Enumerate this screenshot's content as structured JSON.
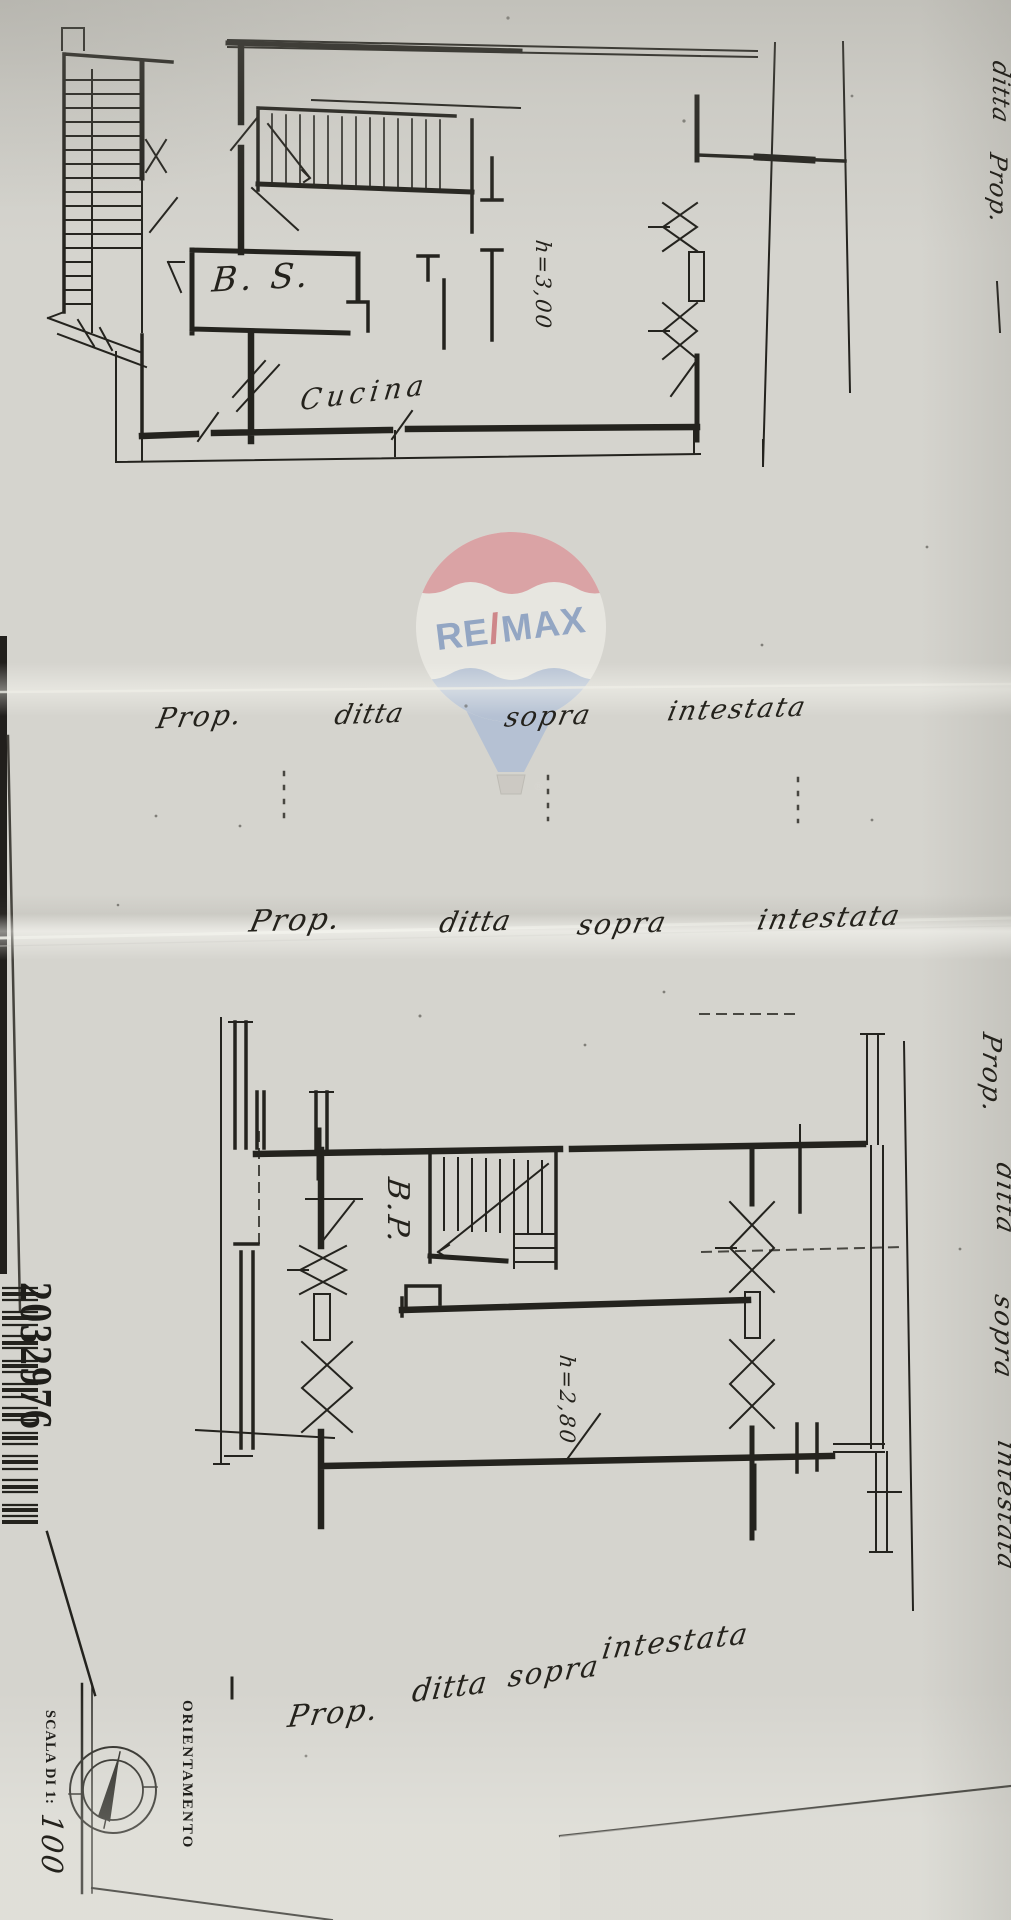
{
  "colors": {
    "paper": "#d5d4ce",
    "ink": "#22211d",
    "balloon_red": "#dc9196",
    "balloon_blue": "#a9bbd6",
    "logo_text_blue": "#7b95c0",
    "logo_slash_red": "#cc6a70",
    "basket_gray": "#c9c6bf"
  },
  "watermark": {
    "brand_left": "RE",
    "brand_slash": "/",
    "brand_right": "MAX",
    "registered": "®"
  },
  "upper_plan": {
    "room_bs": "B. S.",
    "room_kitchen": "Cucina",
    "ceiling_height": "h=3,00"
  },
  "lower_plan": {
    "room_bp": "B.P.",
    "ceiling_height": "h=2,80"
  },
  "annotations": {
    "row1": {
      "w1": "Prop.",
      "w2": "ditta",
      "w3": "sopra",
      "w4": "intestata"
    },
    "row2": {
      "w1": "Prop.",
      "w2": "ditta",
      "w3": "sopra",
      "w4": "intestata"
    },
    "row3": {
      "w1": "Prop.",
      "w2": "ditta",
      "w3": "sopra",
      "w4": "intestata"
    },
    "right_margin": {
      "w1": "Prop.",
      "w2": "ditta",
      "w3": "sopra",
      "w4": "intestata"
    },
    "top_right": {
      "f1": "ditta",
      "f2": "Prop."
    }
  },
  "stamps": {
    "registry_number": "2032976"
  },
  "title_block": {
    "orientation_label": "ORIENTAMENTO",
    "scale_label": "SCALA DI 1:",
    "scale_value": "100"
  }
}
